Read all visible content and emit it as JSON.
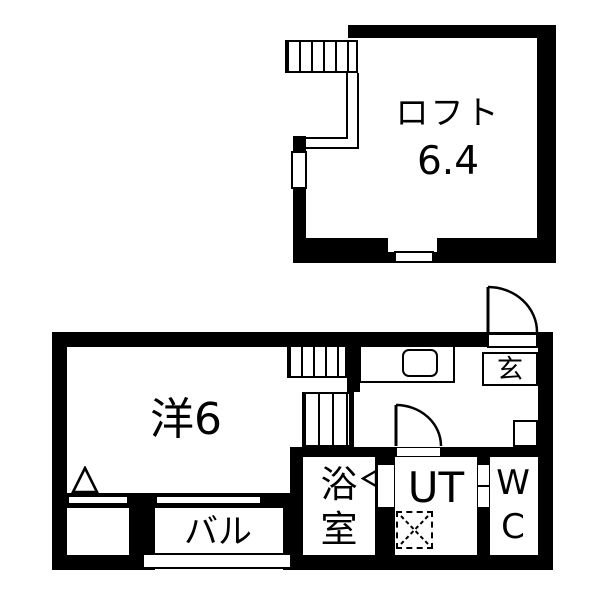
{
  "plan": {
    "title": "apartment floor plan",
    "loft": {
      "label": "ロフト",
      "size": "6.4"
    },
    "floor1": {
      "room_label": "洋6",
      "balcony_label": "バル",
      "bath_label": "浴室",
      "utility_label": "UT",
      "wc_label": "WC",
      "entrance_label": "玄"
    },
    "colors": {
      "wall": "#000000",
      "floor": "#ffffff"
    }
  }
}
